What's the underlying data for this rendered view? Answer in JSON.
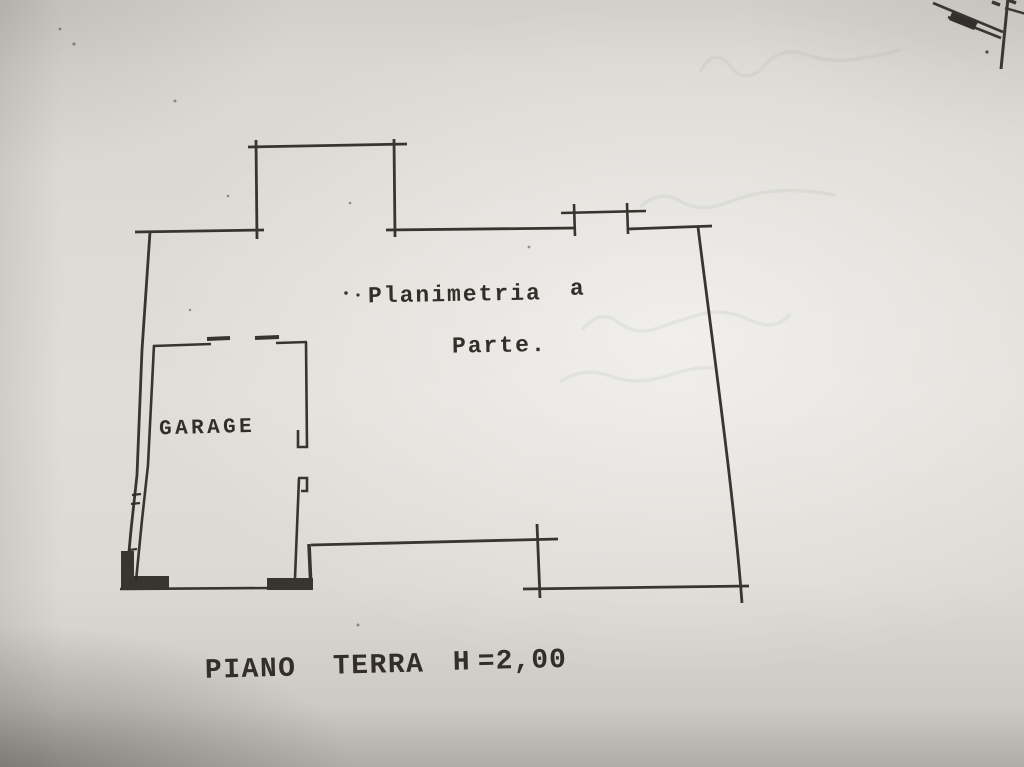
{
  "page": {
    "description": "Photographed cadastral floor plan sheet",
    "paper_color": "#dedbd5",
    "ink_color": "#2e2a26"
  },
  "plan": {
    "annotation_line1": "Planimetria",
    "annotation_line1b": "a",
    "annotation_line2": "Parte.",
    "room_label": "GARAGE",
    "footer": {
      "part1": "PIANO",
      "part2": "TERRA",
      "part3": "H",
      "part4": "=2,00"
    }
  }
}
